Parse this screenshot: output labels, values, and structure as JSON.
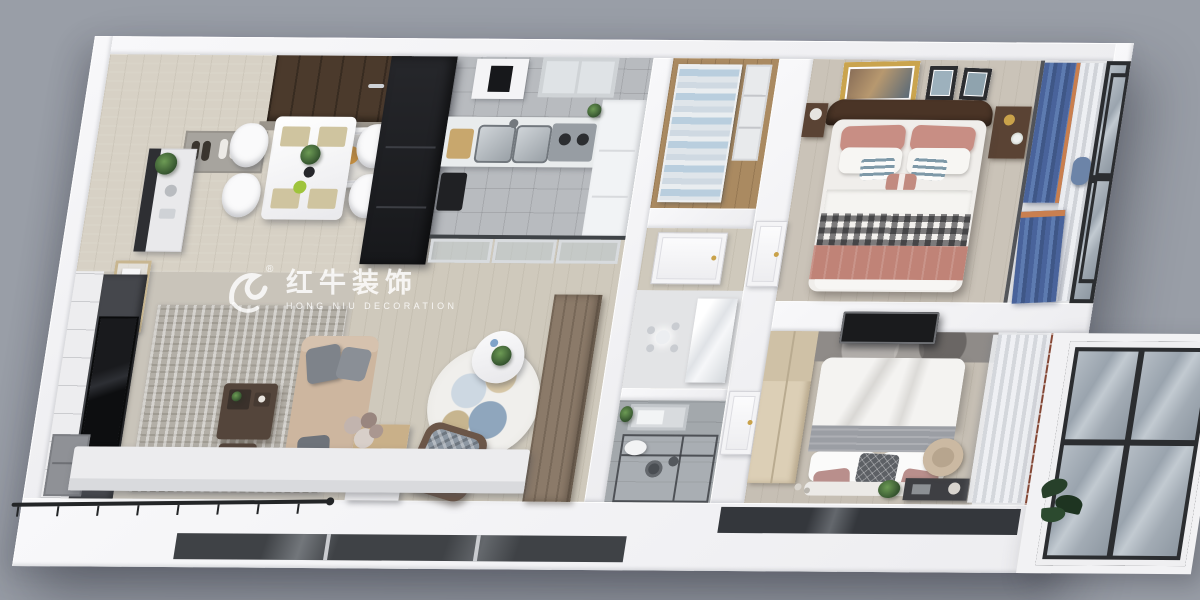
{
  "watermark": {
    "logo": "bull-swoosh-logo",
    "registered_mark": "®",
    "title": "红牛装饰",
    "subtitle": "HONG NIU DECORATION"
  },
  "scene": {
    "type": "3d-apartment-floorplan-render",
    "view": "isometric-top-down-cutaway",
    "rooms": [
      {
        "name": "entry-dining",
        "items": [
          "entry-door",
          "doormat",
          "slippers",
          "wall-art",
          "dining-table",
          "placemats",
          "dining-chairs-x4",
          "flower-centerpiece",
          "sideboard",
          "wall-shelf",
          "potted-plant"
        ]
      },
      {
        "name": "living-room",
        "items": [
          "tv-feature-wall",
          "tv",
          "tv-cabinet",
          "area-rug",
          "sofa",
          "throw-pillows",
          "coffee-table",
          "tea-tray",
          "window-bench",
          "flower-bouquet"
        ]
      },
      {
        "name": "kitchen",
        "items": [
          "tall-black-cabinet",
          "wall-appliance",
          "window",
          "counter",
          "double-sink",
          "faucet",
          "cooktop",
          "cutting-board",
          "cabinets",
          "small-appliance"
        ]
      },
      {
        "name": "walk-in-closet",
        "items": [
          "shelving-unit",
          "folded-clothes",
          "side-shelves"
        ]
      },
      {
        "name": "hallway",
        "items": [
          "sliding-glass-door",
          "round-art-rug",
          "lounge-chair",
          "triangle-side-table",
          "palm-plant",
          "shoe-cabinet",
          "wood-wardrobe",
          "corridor-door"
        ]
      },
      {
        "name": "bathroom-vanity",
        "items": [
          "crystal-chandelier",
          "vanity-unit"
        ]
      },
      {
        "name": "bathroom-shower",
        "items": [
          "skylight-panel",
          "glass-shower-screen",
          "shower-head",
          "toilet",
          "plant"
        ]
      },
      {
        "name": "master-bedroom",
        "items": [
          "wall-art-large",
          "wall-art-small-x2",
          "wood-headboard",
          "nightstand-x2",
          "table-lamp",
          "double-bed",
          "pink-pillows",
          "striped-cushions",
          "gingham-throw",
          "pink-blanket"
        ]
      },
      {
        "name": "master-balcony",
        "items": [
          "blue-curtains",
          "sheer-curtain",
          "floor-to-ceiling-windows",
          "accent-chair"
        ]
      },
      {
        "name": "second-bedroom",
        "items": [
          "wardrobe",
          "marble-headboard-wall",
          "black-ceiling-light",
          "bed-white-grey",
          "diamond-pillow",
          "pink-pillows",
          "desk",
          "desk-chair",
          "plant",
          "sheer-curtains",
          "curtain-rod"
        ]
      },
      {
        "name": "second-balcony",
        "items": [
          "floor-to-ceiling-windows",
          "monstera-plant"
        ]
      },
      {
        "name": "south-balcony-strip",
        "items": [
          "metal-railing",
          "window-glass-band"
        ]
      }
    ]
  },
  "palette": {
    "background": "#999ea7",
    "walls": "#f3f4f6",
    "wood_floor": "#d7d1c5",
    "kitchen_tile": "#b8bbbf",
    "living_rug": "#b3afa7",
    "sofa_beige": "#cdb69f",
    "bed_pink": "#c08377",
    "curtain_blue": "#50699a",
    "glass": "#a9b2ba",
    "dark_units": "#1d1e21"
  }
}
